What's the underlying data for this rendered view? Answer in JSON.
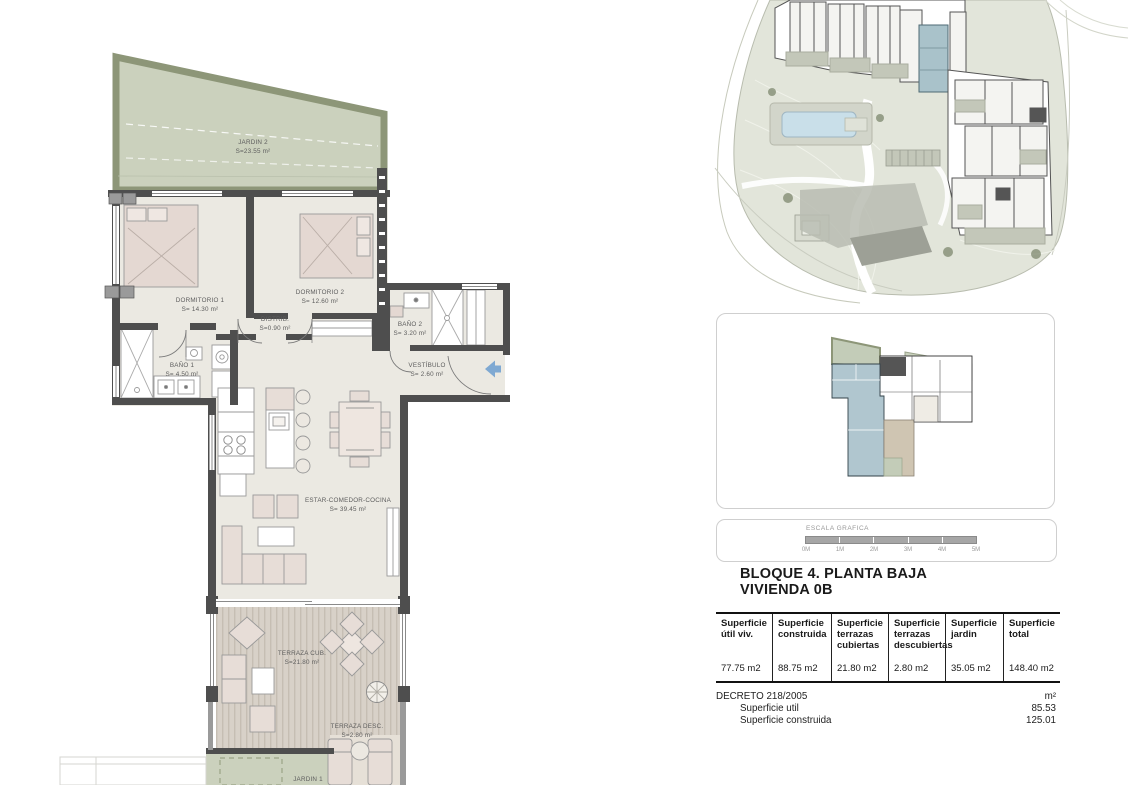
{
  "heading": {
    "line1": "BLOQUE 4. PLANTA BAJA",
    "line2": "VIVIENDA 0B"
  },
  "plan": {
    "rooms": {
      "jardin2": {
        "name": "JARDIN 2",
        "area": "S=23.55 m²"
      },
      "dormitorio1": {
        "name": "DORMITORIO 1",
        "area": "S= 14.30 m²"
      },
      "dormitorio2": {
        "name": "DORMITORIO 2",
        "area": "S= 12.60 m²"
      },
      "bano1": {
        "name": "BAÑO 1",
        "area": "S= 4.50 m²"
      },
      "bano2": {
        "name": "BAÑO 2",
        "area": "S= 3.20 m²"
      },
      "distrib": {
        "name": "DISTRIB.",
        "area": "S=0.90 m²"
      },
      "vestibulo": {
        "name": "VESTÍBULO",
        "area": "S= 2.60 m²"
      },
      "estar": {
        "name": "ESTAR-COMEDOR-COCINA",
        "area": "S= 39.45 m²"
      },
      "terraza_cub": {
        "name": "TERRAZA CUB.",
        "area": "S=21.80 m²"
      },
      "terraza_desc": {
        "name": "TERRAZA DESC.",
        "area": "S=2.80 m²"
      },
      "jardin1": {
        "name": "JARDIN 1"
      }
    }
  },
  "scale_bar": {
    "title": "ESCALA GRAFICA",
    "ticks": [
      "0M",
      "1M",
      "2M",
      "3M",
      "4M",
      "5M"
    ]
  },
  "areas_table": {
    "columns": [
      {
        "header": "Superficie útil viv.",
        "value": "77.75 m2"
      },
      {
        "header": "Superficie construida",
        "value": "88.75 m2"
      },
      {
        "header": "Superficie terrazas cubiertas",
        "value": "21.80 m2"
      },
      {
        "header": "Superficie terrazas descubiertas",
        "value": "2.80 m2"
      },
      {
        "header": "Superficie jardin",
        "value": "35.05 m2"
      },
      {
        "header": "Superficie total",
        "value": "148.40 m2"
      }
    ]
  },
  "decreto": {
    "title": "DECRETO 218/2005",
    "unit": "m²",
    "rows": [
      {
        "label": "Superficie util",
        "value": "85.53"
      },
      {
        "label": "Superficie construida",
        "value": "125.01"
      }
    ]
  },
  "colors": {
    "garden_fill": "#cbd1bd",
    "garden_band": "#8d9678",
    "floor": "#ebe9e2",
    "wall": "#4e4e4e",
    "furniture": "#e7ddd7",
    "terrace": "#d8d1c8",
    "highlight_blue": "#a9c2ca",
    "pool_blue": "#c9dfe9",
    "arrow_blue": "#7fa9d2",
    "landscape": "#e2e5da"
  }
}
